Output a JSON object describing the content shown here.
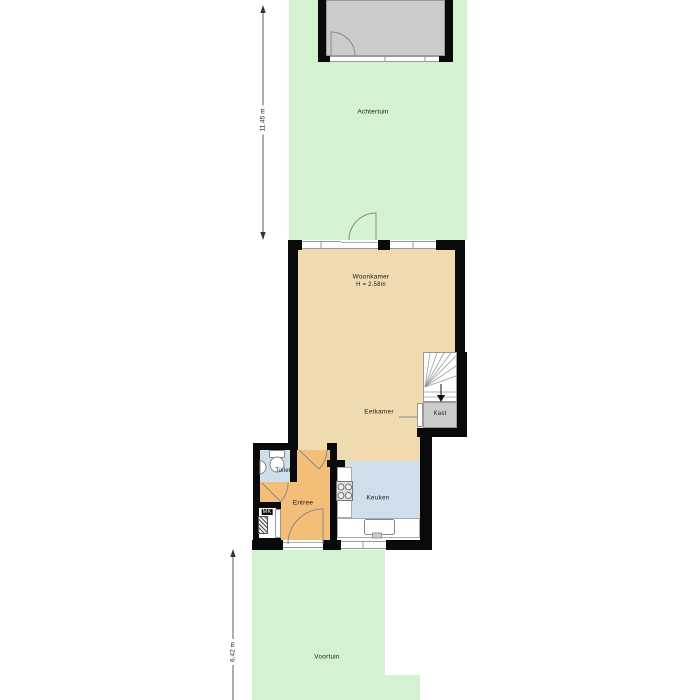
{
  "floorplan": {
    "gardens": {
      "achtertuin_label": "Achtertuin",
      "voortuin_label": "Voortuin"
    },
    "rooms": {
      "woonkamer_label": "Woonkamer",
      "woonkamer_height": "H = 2.58m",
      "eetkamer_label": "Eetkamer",
      "keuken_label": "Keuken",
      "entree_label": "Entree",
      "toilet_label": "Toilet",
      "kast_label": "Kast",
      "mk_label": "MK"
    },
    "dimensions": {
      "upper_left": "11.45 m",
      "lower_left": "6.42 m"
    },
    "colors": {
      "garden_green": "#d4f1d2",
      "living_beige": "#f0dab0",
      "hall_orange": "#f2be78",
      "wet_blue": "#cedeeb",
      "shed_gray": "#cbcbcb",
      "wall_black": "#0a0a0a"
    },
    "icons": {
      "door_swing": "door-swing-icon",
      "stairs": "stairs-down-icon",
      "toilet": "toilet-icon",
      "hand_basin": "hand-basin-icon",
      "cooktop": "cooktop-icon",
      "kitchen_sink": "kitchen-sink-icon",
      "meter_cabinet": "meter-hatch-icon",
      "dimension_arrow": "dimension-arrow-icon"
    }
  }
}
